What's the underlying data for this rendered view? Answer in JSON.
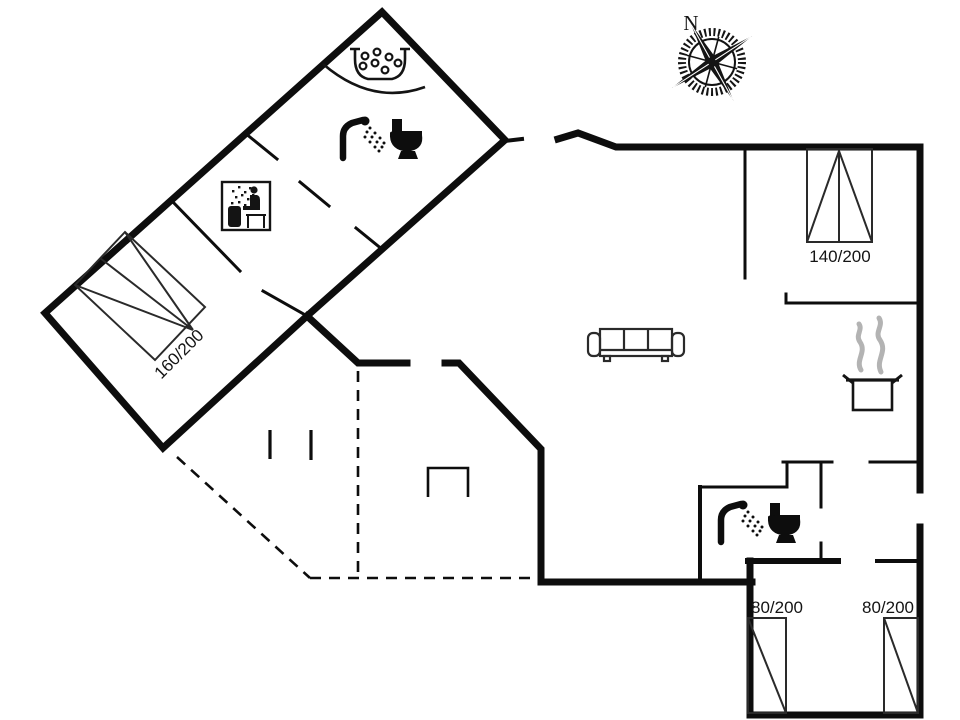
{
  "compass": {
    "label": "N"
  },
  "labels": {
    "bed_nw": "160/200",
    "bed_ne": "140/200",
    "bed_se_left": "80/200",
    "bed_se_right": "80/200"
  },
  "icons": {
    "compass": "compass-rose-icon",
    "whirlpool": "whirlpool-bath-icon",
    "shower_toilet_main": "shower-toilet-icon",
    "shower_toilet_second": "shower-toilet-icon",
    "sauna": "sauna-icon",
    "sofa": "sofa-icon",
    "cooking_pot": "cooking-pot-icon"
  },
  "colors": {
    "wall": "#0d0d0d",
    "steam": "#b3b3b3",
    "background": "#ffffff"
  }
}
